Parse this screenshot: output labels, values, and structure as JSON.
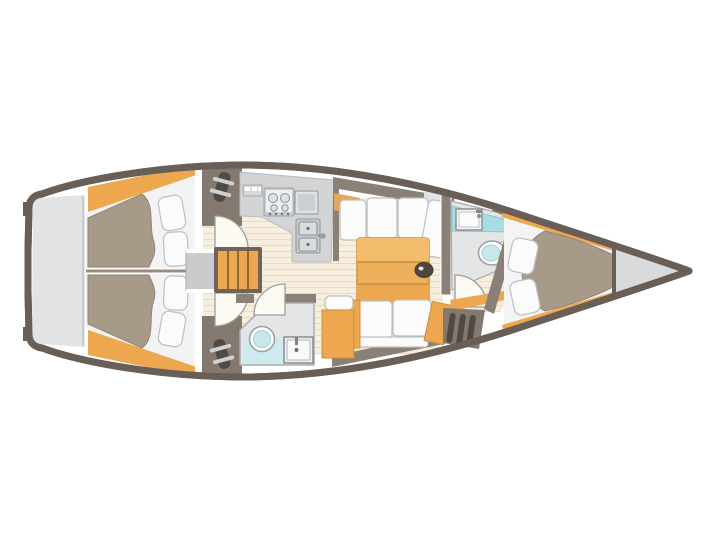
{
  "diagram": {
    "type": "floor-plan",
    "subject": "sailing-yacht-interior-layout-top-view",
    "orientation": "bow-right-stern-left",
    "text_labels": []
  },
  "palette": {
    "hull": "#6a5f57",
    "wall": "#8b8076",
    "deck": "#84796f",
    "deck-dark": "#7b7067",
    "transom": "#e2e3e5",
    "locker": "#c9cbcd",
    "counter": "#d2d4d6",
    "room": "#e4e5e7",
    "mattress": "#a89a89",
    "mattress-edge": "#948678",
    "cushion": "#fbfbfc",
    "cushion-line": "#bdbfc1",
    "wood": "#eca74f",
    "wood-dark": "#d08f3e",
    "wood-light": "#f3bc6d",
    "floor": "#f7eedd",
    "floor-line": "#e9dbc1",
    "cyan": "#a9dde4",
    "cyan-light": "#cdeaee",
    "toilet-cyan": "#c6e8ed",
    "steel": "#c9ccce",
    "steel-light": "#eef0f1",
    "dark": "#4f4a44",
    "bow": "#d9dadc",
    "door": "#fdfaf4",
    "outline": "#9b9ea0"
  },
  "components": {
    "hull": "yacht-hull",
    "swim_platform": "stern-swim-platform",
    "port_aft_cabin": "port-aft-cabin-berth",
    "stbd_aft_cabin": "starboard-aft-cabin-berth",
    "companionway": "companionway-steps",
    "galley": "galley",
    "stove": "stove-4-burner",
    "galley_sink": "double-sink",
    "aft_head": "aft-head-bathroom",
    "salon": "salon-settee",
    "table": "salon-table",
    "nav_cabinet": "cabinet",
    "fwd_head": "forward-head-bathroom",
    "fwd_cabin": "forward-cabin-v-berth",
    "anchor_locker": "bow-anchor-locker"
  }
}
